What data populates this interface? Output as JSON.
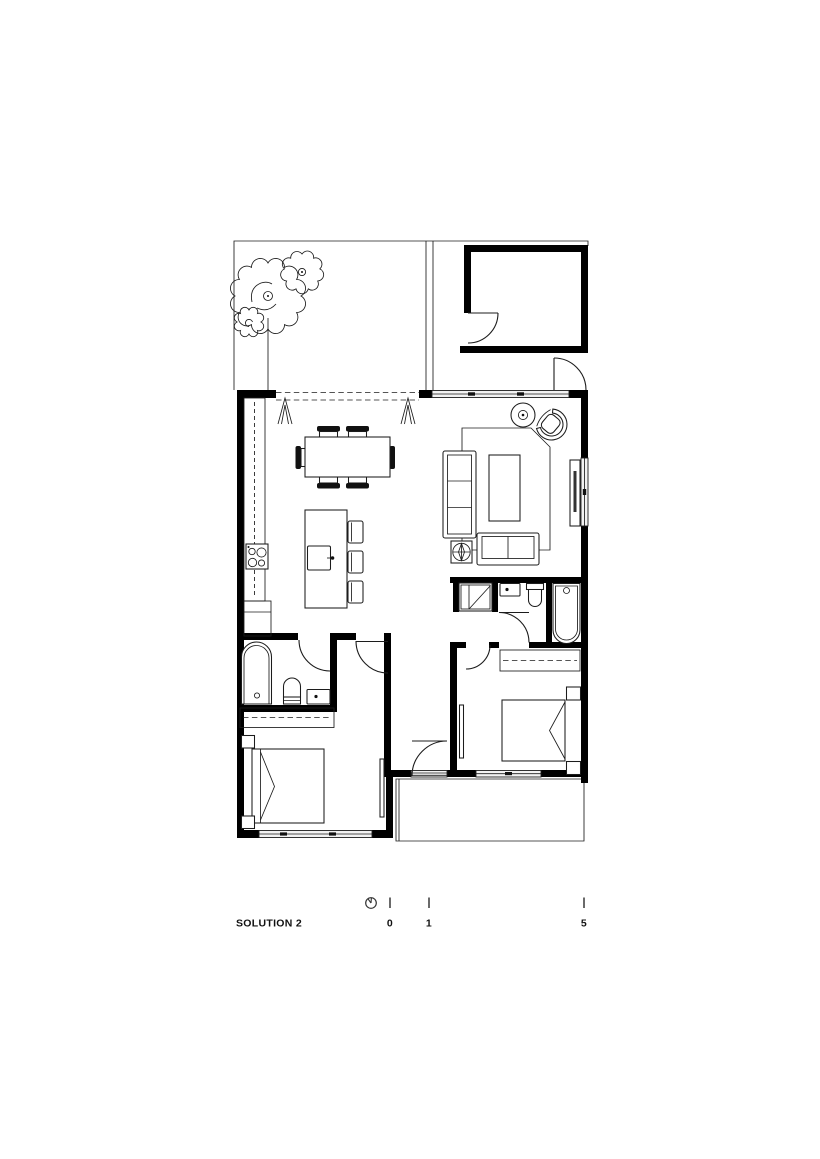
{
  "title": {
    "label": "SOLUTION 2"
  },
  "scale_bar": {
    "ticks": [
      "0",
      "1",
      "5"
    ]
  },
  "colors": {
    "background": "#ffffff",
    "wall": "#000000",
    "line": "#1c1c1c",
    "text": "#111111",
    "glazing": "#f2f2f2",
    "dark_fill": "#111111"
  },
  "symbols": {
    "north_indicator": "small-circle-with-hand",
    "tree": "scalloped-canopy",
    "shrub": "scalloped-shrub",
    "door_swing": "quarter-arc-with-leaf",
    "stacking_door": "dashed-track-with-fold-marks",
    "window": "double-line-with-ticks",
    "rug": "outline-polygon-cut-corner",
    "plant_on_table": "four-point-star-in-circle",
    "cooktop": "four-burner-circles",
    "scale_bar": "three-vertical-ticks"
  },
  "rooms": [
    "courtyard",
    "garage",
    "entry-passage",
    "kitchen",
    "dining-area",
    "living-area",
    "bathroom",
    "hallway",
    "ensuite",
    "bedroom-1",
    "bedroom-2",
    "porch"
  ]
}
